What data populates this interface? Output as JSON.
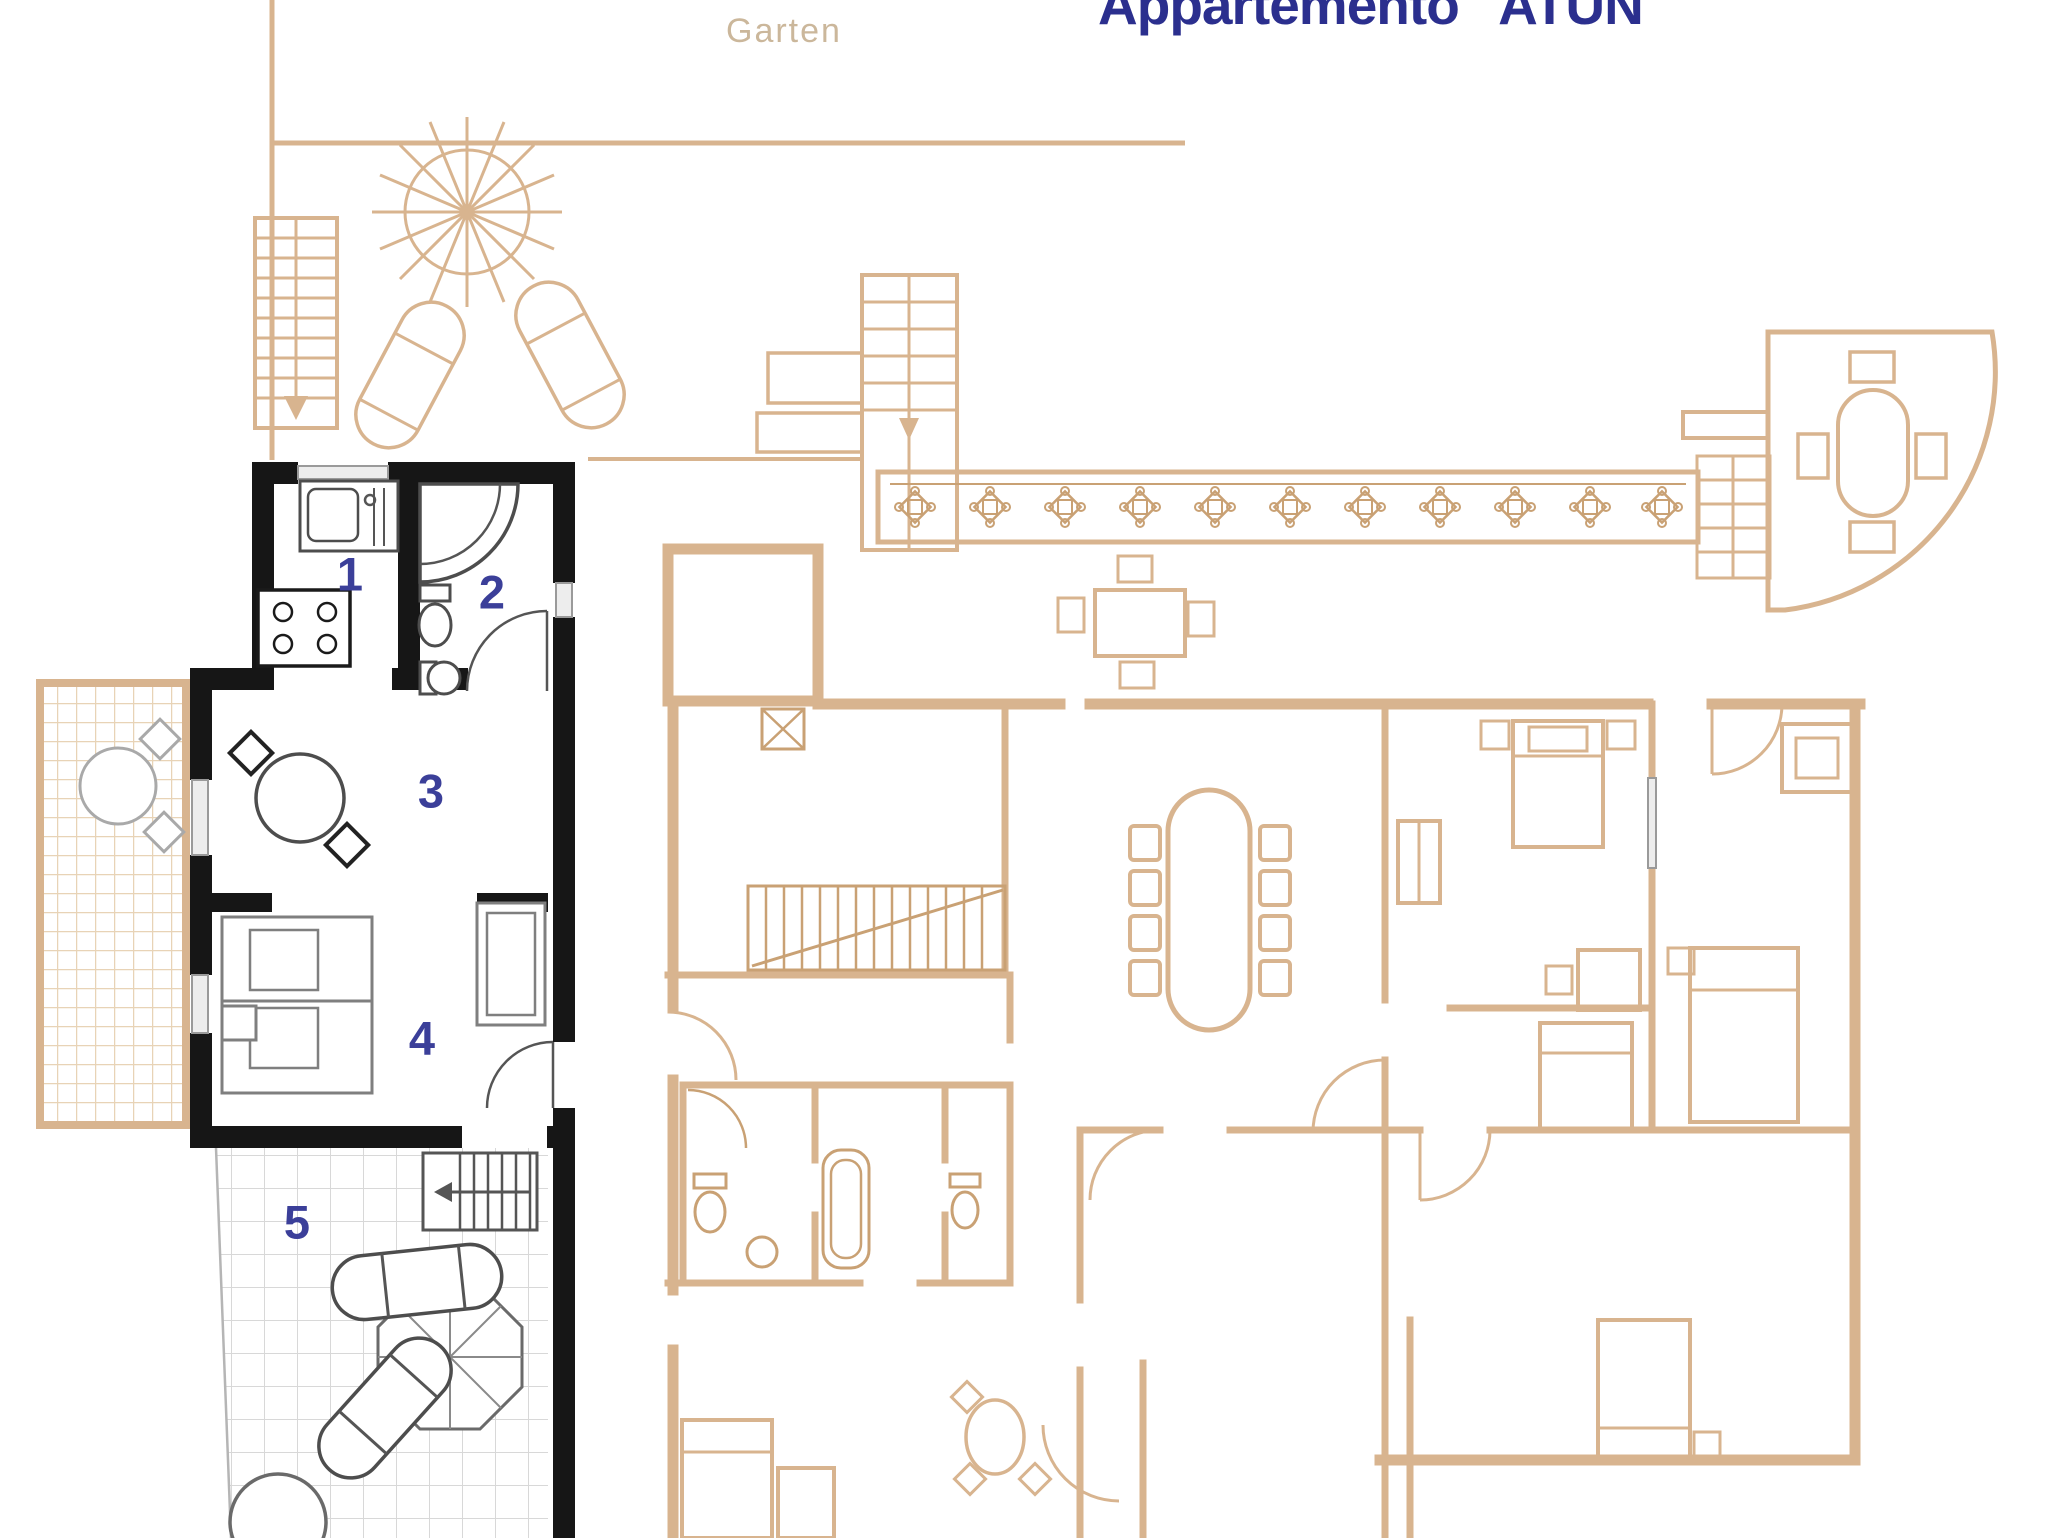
{
  "window": {
    "width": 2048,
    "height": 1538,
    "background": "#ffffff"
  },
  "title": {
    "text": "Appartemento \"ATUN\""
  },
  "garden": {
    "label": "Garten"
  },
  "colors": {
    "accent_navy": "#2b2f8e",
    "number_blue": "#3b3f99",
    "plan_beige": "#d8b48f",
    "plan_beige_dark": "#c9a174",
    "wall_black": "#161616",
    "furniture_gray": "#4d4d4d",
    "grid_gray": "#d8d8d8",
    "garden_text": "#cbb79b"
  },
  "apartment": {
    "name": "Appartemento ATUN",
    "rooms": [
      {
        "number": "1",
        "type": "kitchen"
      },
      {
        "number": "2",
        "type": "bathroom"
      },
      {
        "number": "3",
        "type": "living-dining"
      },
      {
        "number": "4",
        "type": "bedroom"
      },
      {
        "number": "5",
        "type": "terrace"
      }
    ]
  }
}
